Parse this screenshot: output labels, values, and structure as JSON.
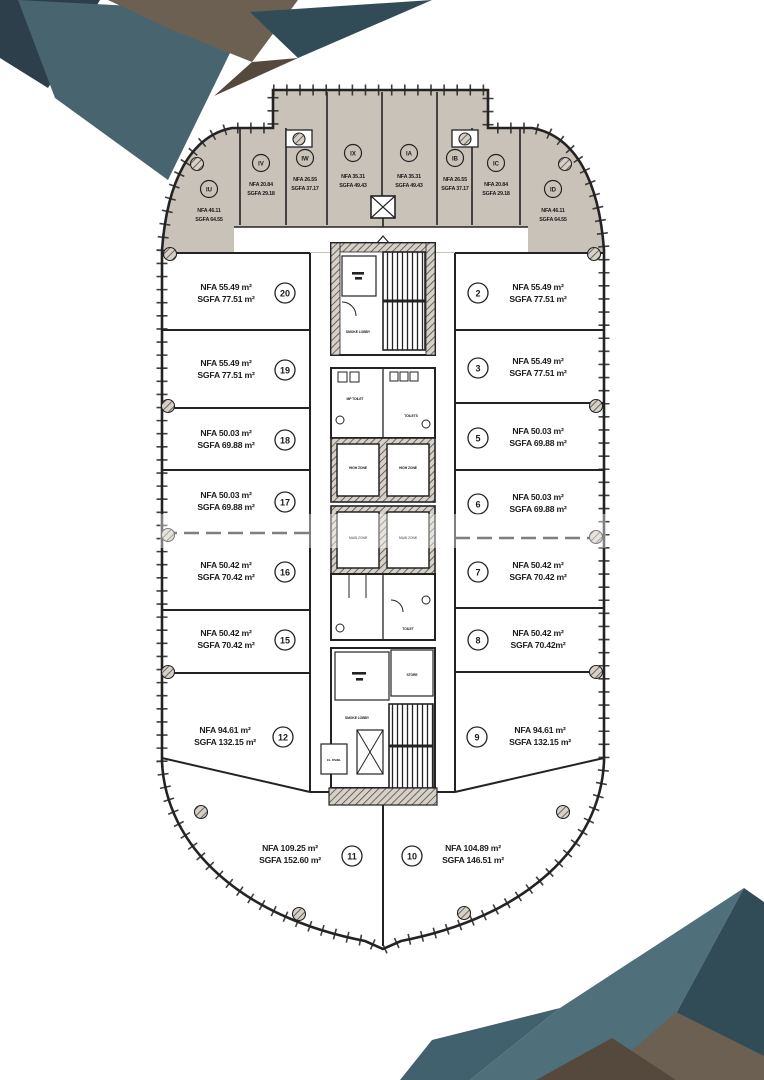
{
  "document": {
    "type": "architectural floor plan"
  },
  "colors": {
    "paper": "#ffffff",
    "wing_fill": "#c9c2b8",
    "line": "#232323",
    "deco_teal": "#48656f",
    "deco_teal_dark": "#314b57",
    "deco_teal_light": "#4f6f7b",
    "deco_navy": "#2c3f4a",
    "deco_brown": "#6b6052",
    "deco_brown_dark": "#55493e"
  },
  "units": {
    "top": [
      {
        "id": "IU",
        "nfa": "NFA 46.11",
        "sgfa": "SGFA 64.55"
      },
      {
        "id": "IV",
        "nfa": "NFA 20.84",
        "sgfa": "SGFA 29.18"
      },
      {
        "id": "IW",
        "nfa": "NFA 26.55",
        "sgfa": "SGFA 37.17"
      },
      {
        "id": "IX",
        "nfa": "NFA 35.31",
        "sgfa": "SGFA 49.43"
      },
      {
        "id": "IA",
        "nfa": "NFA 35.31",
        "sgfa": "SGFA 49.43"
      },
      {
        "id": "IB",
        "nfa": "NFA 26.55",
        "sgfa": "SGFA 37.17"
      },
      {
        "id": "IC",
        "nfa": "NFA 20.84",
        "sgfa": "SGFA 29.18"
      },
      {
        "id": "ID",
        "nfa": "NFA 46.11",
        "sgfa": "SGFA 64.55"
      }
    ],
    "left": [
      {
        "id": "20",
        "nfa": "NFA 55.49 m²",
        "sgfa": "SGFA 77.51 m²"
      },
      {
        "id": "19",
        "nfa": "NFA 55.49 m²",
        "sgfa": "SGFA 77.51 m²"
      },
      {
        "id": "18",
        "nfa": "NFA 50.03 m²",
        "sgfa": "SGFA 69.88 m²"
      },
      {
        "id": "17",
        "nfa": "NFA 50.03 m²",
        "sgfa": "SGFA 69.88 m²"
      },
      {
        "id": "16",
        "nfa": "NFA 50.42 m²",
        "sgfa": "SGFA 70.42 m²"
      },
      {
        "id": "15",
        "nfa": "NFA 50.42 m²",
        "sgfa": "SGFA 70.42 m²"
      },
      {
        "id": "12",
        "nfa": "NFA 94.61 m²",
        "sgfa": "SGFA 132.15 m²"
      }
    ],
    "right": [
      {
        "id": "2",
        "nfa": "NFA 55.49 m²",
        "sgfa": "SGFA 77.51 m²"
      },
      {
        "id": "3",
        "nfa": "NFA 55.49 m²",
        "sgfa": "SGFA 77.51 m²"
      },
      {
        "id": "5",
        "nfa": "NFA 50.03 m²",
        "sgfa": "SGFA 69.88 m²"
      },
      {
        "id": "6",
        "nfa": "NFA 50.03 m²",
        "sgfa": "SGFA 69.88 m²"
      },
      {
        "id": "7",
        "nfa": "NFA 50.42 m²",
        "sgfa": "SGFA 70.42 m²"
      },
      {
        "id": "8",
        "nfa": "NFA 50.42 m²",
        "sgfa": "SGFA 70.42m²"
      },
      {
        "id": "9",
        "nfa": "NFA 94.61 m²",
        "sgfa": "SGFA 132.15 m²"
      }
    ],
    "bottom": [
      {
        "id": "11",
        "nfa": "NFA 109.25 m²",
        "sgfa": "SGFA 152.60 m²"
      },
      {
        "id": "10",
        "nfa": "NFA 104.89 m²",
        "sgfa": "SGFA 146.51 m²"
      }
    ]
  },
  "core": {
    "labels": {
      "smoke_lobby_top": "SMOKE LOBBY",
      "mp_toilet": "MP TOILET",
      "toilets": "TOILETS",
      "lift_high_left": "HIGH ZONE",
      "lift_high_right": "HIGH ZONE",
      "lift_main_left": "MAIN ZONE",
      "lift_main_right": "MAIN ZONE",
      "toilet_low": "TOILET",
      "store": "STORE",
      "smoke_lobby_bottom": "SMOKE LOBBY",
      "el_panel": "EL. PANEL"
    }
  }
}
